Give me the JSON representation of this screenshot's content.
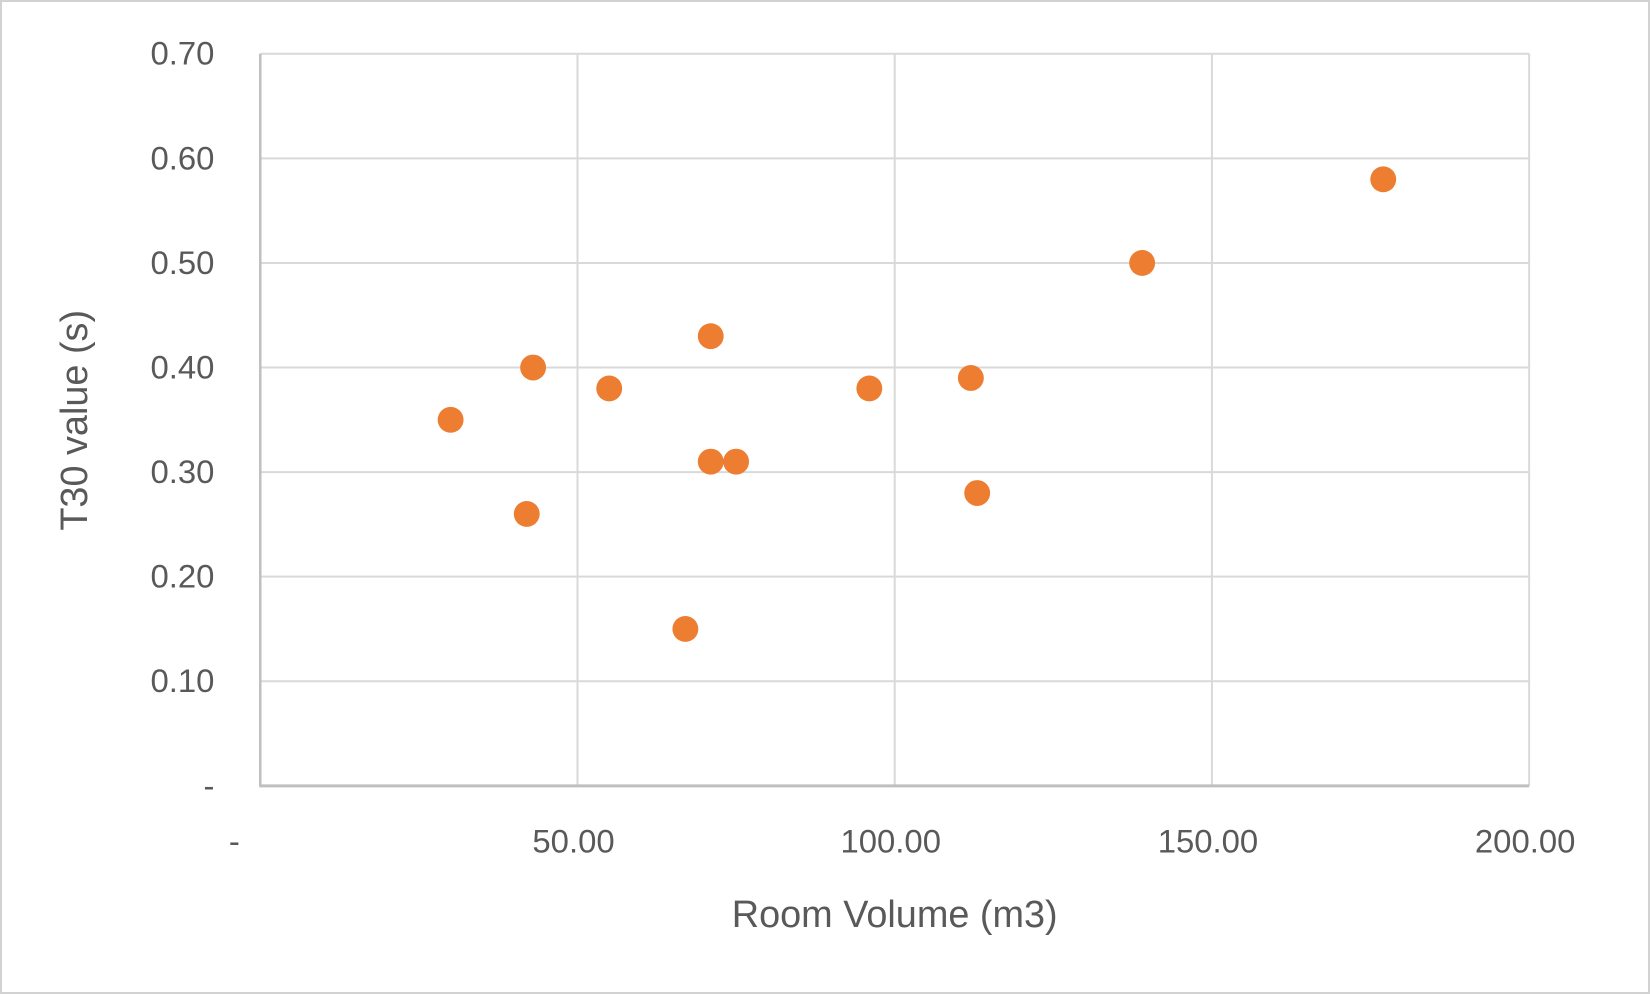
{
  "chart_data": {
    "type": "scatter",
    "title": "",
    "xlabel": "Room Volume (m3)",
    "ylabel": "T30 value (s)",
    "xlim": [
      0,
      200
    ],
    "ylim": [
      0,
      0.7
    ],
    "grid": true,
    "legend_position": "none",
    "x_ticks": [
      {
        "value": 0,
        "label": "-"
      },
      {
        "value": 50,
        "label": "50.00"
      },
      {
        "value": 100,
        "label": "100.00"
      },
      {
        "value": 150,
        "label": "150.00"
      },
      {
        "value": 200,
        "label": "200.00"
      }
    ],
    "y_ticks": [
      {
        "value": 0.0,
        "label": "-"
      },
      {
        "value": 0.1,
        "label": "0.10"
      },
      {
        "value": 0.2,
        "label": "0.20"
      },
      {
        "value": 0.3,
        "label": "0.30"
      },
      {
        "value": 0.4,
        "label": "0.40"
      },
      {
        "value": 0.5,
        "label": "0.50"
      },
      {
        "value": 0.6,
        "label": "0.60"
      },
      {
        "value": 0.7,
        "label": "0.70"
      }
    ],
    "points": [
      {
        "x": 30,
        "y": 0.35
      },
      {
        "x": 42,
        "y": 0.26
      },
      {
        "x": 43,
        "y": 0.4
      },
      {
        "x": 55,
        "y": 0.38
      },
      {
        "x": 67,
        "y": 0.15
      },
      {
        "x": 71,
        "y": 0.43
      },
      {
        "x": 71,
        "y": 0.31
      },
      {
        "x": 75,
        "y": 0.31
      },
      {
        "x": 96,
        "y": 0.38
      },
      {
        "x": 112,
        "y": 0.39
      },
      {
        "x": 113,
        "y": 0.28
      },
      {
        "x": 139,
        "y": 0.5
      },
      {
        "x": 177,
        "y": 0.58
      }
    ]
  },
  "colors": {
    "marker": "#ED7D31",
    "gridline": "#D9D9D9",
    "axis_line": "#BFBFBF",
    "text": "#595959",
    "frame_border": "#D2D2D2",
    "background": "#FFFFFF"
  }
}
